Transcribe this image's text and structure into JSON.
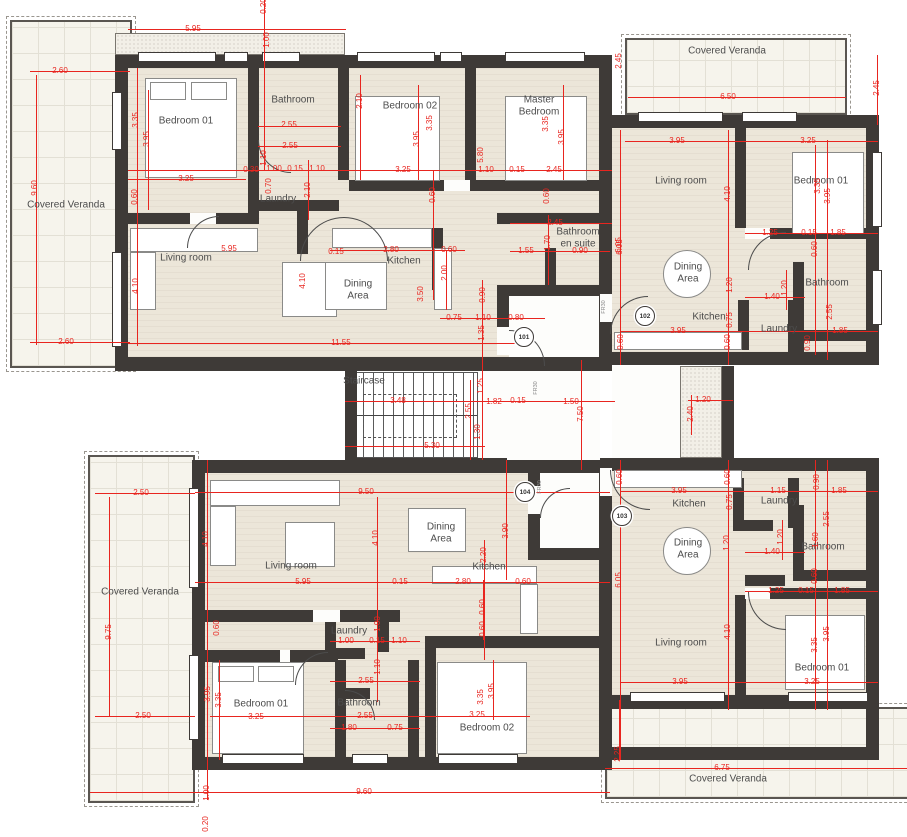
{
  "drawing": {
    "type": "architectural-floor-plan",
    "colors": {
      "wall": "#3e3a37",
      "floor": "#ece6d9",
      "veranda": "#f6f4ec",
      "dimension_red": "#e8251f",
      "label_gray": "#4c4c4c"
    },
    "units": [
      {
        "number": "101",
        "rooms": [
          "Bedroom 01",
          "Bathroom",
          "Laundry",
          "Bedroom 02",
          "Master Bedroom",
          "Bathroom en suite",
          "Living room",
          "Dining Area",
          "Kitchen",
          "Covered Veranda"
        ]
      },
      {
        "number": "102",
        "rooms": [
          "Covered Veranda",
          "Living room",
          "Bedroom 01",
          "Dining Area",
          "Kitchen",
          "Bathroom",
          "Laundry"
        ]
      },
      {
        "number": "103",
        "rooms": [
          "Kitchen",
          "Laundry",
          "Bathroom",
          "Dining Area",
          "Living room",
          "Bedroom 01",
          "Covered Veranda"
        ]
      },
      {
        "number": "104",
        "rooms": [
          "Living room",
          "Dining Area",
          "Kitchen",
          "Laundry",
          "Bedroom 01",
          "Bathroom",
          "Bedroom 02",
          "Covered Veranda"
        ]
      }
    ],
    "common_areas": [
      "Staircase"
    ],
    "unit_badges": [
      {
        "n": "101",
        "x": 524,
        "y": 337
      },
      {
        "n": "102",
        "x": 645,
        "y": 316
      },
      {
        "n": "103",
        "x": 622,
        "y": 516
      },
      {
        "n": "104",
        "x": 525,
        "y": 492
      }
    ],
    "door_labels": [
      {
        "t": "FR30",
        "x": 536,
        "y": 388
      },
      {
        "t": "FR30",
        "x": 604,
        "y": 307
      },
      {
        "t": "FR30",
        "x": 540,
        "y": 487
      }
    ],
    "room_labels": [
      {
        "t": "Covered Veranda",
        "x": 66,
        "y": 205
      },
      {
        "t": "Bedroom 01",
        "x": 186,
        "y": 121
      },
      {
        "t": "Bathroom",
        "x": 293,
        "y": 100
      },
      {
        "t": "Laundry",
        "x": 278,
        "y": 199
      },
      {
        "t": "Bedroom 02",
        "x": 410,
        "y": 106
      },
      {
        "t": "Master\nBedroom",
        "x": 539,
        "y": 106
      },
      {
        "t": "Bathroom\nen suite",
        "x": 578,
        "y": 238
      },
      {
        "t": "Living room",
        "x": 186,
        "y": 258
      },
      {
        "t": "Dining\nArea",
        "x": 358,
        "y": 290
      },
      {
        "t": "Kitchen",
        "x": 404,
        "y": 261
      },
      {
        "t": "Covered Veranda",
        "x": 727,
        "y": 51
      },
      {
        "t": "Living room",
        "x": 681,
        "y": 181
      },
      {
        "t": "Bedroom 01",
        "x": 821,
        "y": 181
      },
      {
        "t": "Dining\nArea",
        "x": 688,
        "y": 273
      },
      {
        "t": "Kitchen",
        "x": 709,
        "y": 317
      },
      {
        "t": "Bathroom",
        "x": 827,
        "y": 283
      },
      {
        "t": "Laundry",
        "x": 779,
        "y": 329
      },
      {
        "t": "Staircase",
        "x": 364,
        "y": 381
      },
      {
        "t": "Covered Veranda",
        "x": 140,
        "y": 592
      },
      {
        "t": "Living room",
        "x": 291,
        "y": 566
      },
      {
        "t": "Dining\nArea",
        "x": 441,
        "y": 533
      },
      {
        "t": "Kitchen",
        "x": 489,
        "y": 567
      },
      {
        "t": "Laundry",
        "x": 349,
        "y": 631
      },
      {
        "t": "Bedroom 01",
        "x": 261,
        "y": 704
      },
      {
        "t": "Bathroom",
        "x": 359,
        "y": 703
      },
      {
        "t": "Bedroom 02",
        "x": 487,
        "y": 728
      },
      {
        "t": "Kitchen",
        "x": 689,
        "y": 504
      },
      {
        "t": "Laundry",
        "x": 779,
        "y": 501
      },
      {
        "t": "Bathroom",
        "x": 823,
        "y": 547
      },
      {
        "t": "Dining\nArea",
        "x": 688,
        "y": 549
      },
      {
        "t": "Living room",
        "x": 681,
        "y": 643
      },
      {
        "t": "Bedroom 01",
        "x": 822,
        "y": 668
      },
      {
        "t": "Covered Veranda",
        "x": 728,
        "y": 779
      }
    ],
    "dimensions": [
      {
        "t": "5.95",
        "x": 193,
        "y": 29,
        "o": "h"
      },
      {
        "t": "0.20",
        "x": 264,
        "y": 6,
        "o": "v"
      },
      {
        "t": "1.00",
        "x": 267,
        "y": 40,
        "o": "v"
      },
      {
        "t": "2.60",
        "x": 60,
        "y": 71,
        "o": "h"
      },
      {
        "t": "9.60",
        "x": 35,
        "y": 188,
        "o": "v"
      },
      {
        "t": "2.60",
        "x": 66,
        "y": 342,
        "o": "h"
      },
      {
        "t": "3.35",
        "x": 136,
        "y": 120,
        "o": "v"
      },
      {
        "t": "3.95",
        "x": 147,
        "y": 139,
        "o": "v"
      },
      {
        "t": "3.25",
        "x": 186,
        "y": 179,
        "o": "h"
      },
      {
        "t": "0.60",
        "x": 135,
        "y": 197,
        "o": "v"
      },
      {
        "t": "4.10",
        "x": 136,
        "y": 286,
        "o": "v"
      },
      {
        "t": "5.95",
        "x": 229,
        "y": 249,
        "o": "h"
      },
      {
        "t": "2.55",
        "x": 289,
        "y": 125,
        "o": "h"
      },
      {
        "t": "2.55",
        "x": 290,
        "y": 146,
        "o": "h"
      },
      {
        "t": "1.10",
        "x": 264,
        "y": 158,
        "o": "v"
      },
      {
        "t": "0.30",
        "x": 251,
        "y": 170,
        "o": "h"
      },
      {
        "t": "1.00",
        "x": 274,
        "y": 169,
        "o": "h"
      },
      {
        "t": "0.15",
        "x": 295,
        "y": 169,
        "o": "h"
      },
      {
        "t": "1.10",
        "x": 317,
        "y": 169,
        "o": "h"
      },
      {
        "t": "0.70",
        "x": 269,
        "y": 186,
        "o": "v"
      },
      {
        "t": "2.10",
        "x": 308,
        "y": 190,
        "o": "v"
      },
      {
        "t": "2.10",
        "x": 360,
        "y": 101,
        "o": "v"
      },
      {
        "t": "3.35",
        "x": 430,
        "y": 123,
        "o": "v"
      },
      {
        "t": "3.95",
        "x": 417,
        "y": 139,
        "o": "v"
      },
      {
        "t": "3.25",
        "x": 403,
        "y": 170,
        "o": "h"
      },
      {
        "t": "1.10",
        "x": 486,
        "y": 170,
        "o": "h"
      },
      {
        "t": "0.15",
        "x": 517,
        "y": 170,
        "o": "h"
      },
      {
        "t": "2.45",
        "x": 554,
        "y": 170,
        "o": "h"
      },
      {
        "t": "5.80",
        "x": 481,
        "y": 155,
        "o": "v"
      },
      {
        "t": "3.35",
        "x": 546,
        "y": 124,
        "o": "v"
      },
      {
        "t": "3.95",
        "x": 562,
        "y": 137,
        "o": "v"
      },
      {
        "t": "0.60",
        "x": 433,
        "y": 195,
        "o": "v"
      },
      {
        "t": "0.60",
        "x": 547,
        "y": 196,
        "o": "v"
      },
      {
        "t": "2.45",
        "x": 555,
        "y": 223,
        "o": "h"
      },
      {
        "t": "1.70",
        "x": 548,
        "y": 243,
        "o": "v"
      },
      {
        "t": "1.55",
        "x": 526,
        "y": 251,
        "o": "h"
      },
      {
        "t": "0.90",
        "x": 580,
        "y": 251,
        "o": "h"
      },
      {
        "t": "6.05",
        "x": 619,
        "y": 245,
        "o": "v"
      },
      {
        "t": "0.15",
        "x": 336,
        "y": 252,
        "o": "h"
      },
      {
        "t": "2.80",
        "x": 391,
        "y": 250,
        "o": "h"
      },
      {
        "t": "0.60",
        "x": 449,
        "y": 250,
        "o": "h"
      },
      {
        "t": "2.00",
        "x": 445,
        "y": 273,
        "o": "v"
      },
      {
        "t": "3.50",
        "x": 421,
        "y": 294,
        "o": "v"
      },
      {
        "t": "4.10",
        "x": 303,
        "y": 281,
        "o": "v"
      },
      {
        "t": "0.90",
        "x": 483,
        "y": 295,
        "o": "v"
      },
      {
        "t": "0.75",
        "x": 454,
        "y": 318,
        "o": "h"
      },
      {
        "t": "1.10",
        "x": 483,
        "y": 318,
        "o": "h"
      },
      {
        "t": "0.80",
        "x": 516,
        "y": 318,
        "o": "h"
      },
      {
        "t": "1.35",
        "x": 482,
        "y": 333,
        "o": "v"
      },
      {
        "t": "11.55",
        "x": 341,
        "y": 343,
        "o": "h"
      },
      {
        "t": "1.25",
        "x": 481,
        "y": 386,
        "o": "v"
      },
      {
        "t": "3.48",
        "x": 398,
        "y": 401,
        "o": "h"
      },
      {
        "t": "1.82",
        "x": 494,
        "y": 402,
        "o": "h"
      },
      {
        "t": "0.15",
        "x": 518,
        "y": 401,
        "o": "h"
      },
      {
        "t": "1.50",
        "x": 571,
        "y": 402,
        "o": "h"
      },
      {
        "t": "2.55",
        "x": 469,
        "y": 411,
        "o": "v"
      },
      {
        "t": "1.30",
        "x": 478,
        "y": 432,
        "o": "v"
      },
      {
        "t": "5.30",
        "x": 432,
        "y": 446,
        "o": "h"
      },
      {
        "t": "7.50",
        "x": 581,
        "y": 414,
        "o": "v"
      },
      {
        "t": "1.20",
        "x": 703,
        "y": 400,
        "o": "h"
      },
      {
        "t": "2.40",
        "x": 691,
        "y": 414,
        "o": "v"
      },
      {
        "t": "3.90",
        "x": 506,
        "y": 531,
        "o": "v"
      },
      {
        "t": "2.45",
        "x": 619,
        "y": 61,
        "o": "v"
      },
      {
        "t": "6.50",
        "x": 728,
        "y": 97,
        "o": "h"
      },
      {
        "t": "2.45",
        "x": 877,
        "y": 88,
        "o": "v"
      },
      {
        "t": "3.95",
        "x": 677,
        "y": 141,
        "o": "h"
      },
      {
        "t": "3.25",
        "x": 808,
        "y": 141,
        "o": "h"
      },
      {
        "t": "4.10",
        "x": 728,
        "y": 194,
        "o": "v"
      },
      {
        "t": "6.05",
        "x": 620,
        "y": 247,
        "o": "v"
      },
      {
        "t": "3.35",
        "x": 818,
        "y": 186,
        "o": "v"
      },
      {
        "t": "3.95",
        "x": 828,
        "y": 196,
        "o": "v"
      },
      {
        "t": "1.25",
        "x": 770,
        "y": 233,
        "o": "h"
      },
      {
        "t": "0.15",
        "x": 809,
        "y": 233,
        "o": "h"
      },
      {
        "t": "1.85",
        "x": 838,
        "y": 233,
        "o": "h"
      },
      {
        "t": "0.60",
        "x": 815,
        "y": 249,
        "o": "v"
      },
      {
        "t": "1.20",
        "x": 730,
        "y": 285,
        "o": "v"
      },
      {
        "t": "1.20",
        "x": 785,
        "y": 288,
        "o": "v"
      },
      {
        "t": "1.40",
        "x": 772,
        "y": 297,
        "o": "h"
      },
      {
        "t": "2.55",
        "x": 830,
        "y": 312,
        "o": "v"
      },
      {
        "t": "0.75",
        "x": 730,
        "y": 320,
        "o": "v"
      },
      {
        "t": "3.95",
        "x": 678,
        "y": 331,
        "o": "h"
      },
      {
        "t": "1.85",
        "x": 840,
        "y": 331,
        "o": "h"
      },
      {
        "t": "0.90",
        "x": 808,
        "y": 343,
        "o": "v"
      },
      {
        "t": "0.60",
        "x": 621,
        "y": 342,
        "o": "v"
      },
      {
        "t": "0.60",
        "x": 728,
        "y": 342,
        "o": "v"
      },
      {
        "t": "2.50",
        "x": 141,
        "y": 493,
        "o": "h"
      },
      {
        "t": "9.75",
        "x": 109,
        "y": 632,
        "o": "v"
      },
      {
        "t": "2.50",
        "x": 143,
        "y": 716,
        "o": "h"
      },
      {
        "t": "4.10",
        "x": 206,
        "y": 539,
        "o": "v"
      },
      {
        "t": "9.50",
        "x": 366,
        "y": 492,
        "o": "h"
      },
      {
        "t": "4.10",
        "x": 376,
        "y": 538,
        "o": "v"
      },
      {
        "t": "5.95",
        "x": 303,
        "y": 582,
        "o": "h"
      },
      {
        "t": "0.15",
        "x": 400,
        "y": 582,
        "o": "h"
      },
      {
        "t": "2.80",
        "x": 463,
        "y": 582,
        "o": "h"
      },
      {
        "t": "0.60",
        "x": 523,
        "y": 582,
        "o": "h"
      },
      {
        "t": "2.20",
        "x": 484,
        "y": 555,
        "o": "v"
      },
      {
        "t": "0.60",
        "x": 483,
        "y": 607,
        "o": "v"
      },
      {
        "t": "0.60",
        "x": 483,
        "y": 629,
        "o": "v"
      },
      {
        "t": "0.60",
        "x": 217,
        "y": 628,
        "o": "v"
      },
      {
        "t": "1.00",
        "x": 378,
        "y": 624,
        "o": "v"
      },
      {
        "t": "1.00",
        "x": 346,
        "y": 641,
        "o": "h"
      },
      {
        "t": "0.15",
        "x": 377,
        "y": 641,
        "o": "h"
      },
      {
        "t": "1.10",
        "x": 399,
        "y": 641,
        "o": "h"
      },
      {
        "t": "1.10",
        "x": 378,
        "y": 667,
        "o": "v"
      },
      {
        "t": "2.55",
        "x": 366,
        "y": 681,
        "o": "h"
      },
      {
        "t": "2.55",
        "x": 365,
        "y": 716,
        "o": "h"
      },
      {
        "t": "3.95",
        "x": 208,
        "y": 694,
        "o": "v"
      },
      {
        "t": "3.35",
        "x": 219,
        "y": 700,
        "o": "v"
      },
      {
        "t": "3.25",
        "x": 256,
        "y": 717,
        "o": "h"
      },
      {
        "t": "1.80",
        "x": 349,
        "y": 728,
        "o": "h"
      },
      {
        "t": "0.75",
        "x": 395,
        "y": 728,
        "o": "h"
      },
      {
        "t": "3.35",
        "x": 481,
        "y": 697,
        "o": "v"
      },
      {
        "t": "3.95",
        "x": 492,
        "y": 691,
        "o": "v"
      },
      {
        "t": "3.25",
        "x": 477,
        "y": 715,
        "o": "h"
      },
      {
        "t": "9.60",
        "x": 364,
        "y": 792,
        "o": "h"
      },
      {
        "t": "1.00",
        "x": 207,
        "y": 793,
        "o": "v"
      },
      {
        "t": "0.20",
        "x": 206,
        "y": 824,
        "o": "v"
      },
      {
        "t": "0.60",
        "x": 620,
        "y": 477,
        "o": "v"
      },
      {
        "t": "3.95",
        "x": 679,
        "y": 491,
        "o": "h"
      },
      {
        "t": "0.60",
        "x": 728,
        "y": 477,
        "o": "v"
      },
      {
        "t": "0.75",
        "x": 730,
        "y": 502,
        "o": "v"
      },
      {
        "t": "1.15",
        "x": 778,
        "y": 491,
        "o": "h"
      },
      {
        "t": "0.90",
        "x": 817,
        "y": 482,
        "o": "v"
      },
      {
        "t": "1.85",
        "x": 839,
        "y": 491,
        "o": "h"
      },
      {
        "t": "2.55",
        "x": 827,
        "y": 519,
        "o": "v"
      },
      {
        "t": "1.20",
        "x": 727,
        "y": 543,
        "o": "v"
      },
      {
        "t": "1.20",
        "x": 781,
        "y": 537,
        "o": "v"
      },
      {
        "t": "1.40",
        "x": 772,
        "y": 552,
        "o": "h"
      },
      {
        "t": "1.60",
        "x": 816,
        "y": 540,
        "o": "v"
      },
      {
        "t": "6.05",
        "x": 619,
        "y": 580,
        "o": "v"
      },
      {
        "t": "0.60",
        "x": 815,
        "y": 576,
        "o": "v"
      },
      {
        "t": "1.25",
        "x": 776,
        "y": 591,
        "o": "h"
      },
      {
        "t": "0.15",
        "x": 806,
        "y": 591,
        "o": "h"
      },
      {
        "t": "1.85",
        "x": 842,
        "y": 591,
        "o": "h"
      },
      {
        "t": "4.10",
        "x": 728,
        "y": 632,
        "o": "v"
      },
      {
        "t": "3.35",
        "x": 815,
        "y": 645,
        "o": "v"
      },
      {
        "t": "3.95",
        "x": 827,
        "y": 634,
        "o": "v"
      },
      {
        "t": "3.95",
        "x": 680,
        "y": 682,
        "o": "h"
      },
      {
        "t": "3.25",
        "x": 812,
        "y": 682,
        "o": "h"
      },
      {
        "t": "2.25",
        "x": 618,
        "y": 754,
        "o": "v"
      },
      {
        "t": "6.75",
        "x": 722,
        "y": 768,
        "o": "h"
      }
    ]
  }
}
